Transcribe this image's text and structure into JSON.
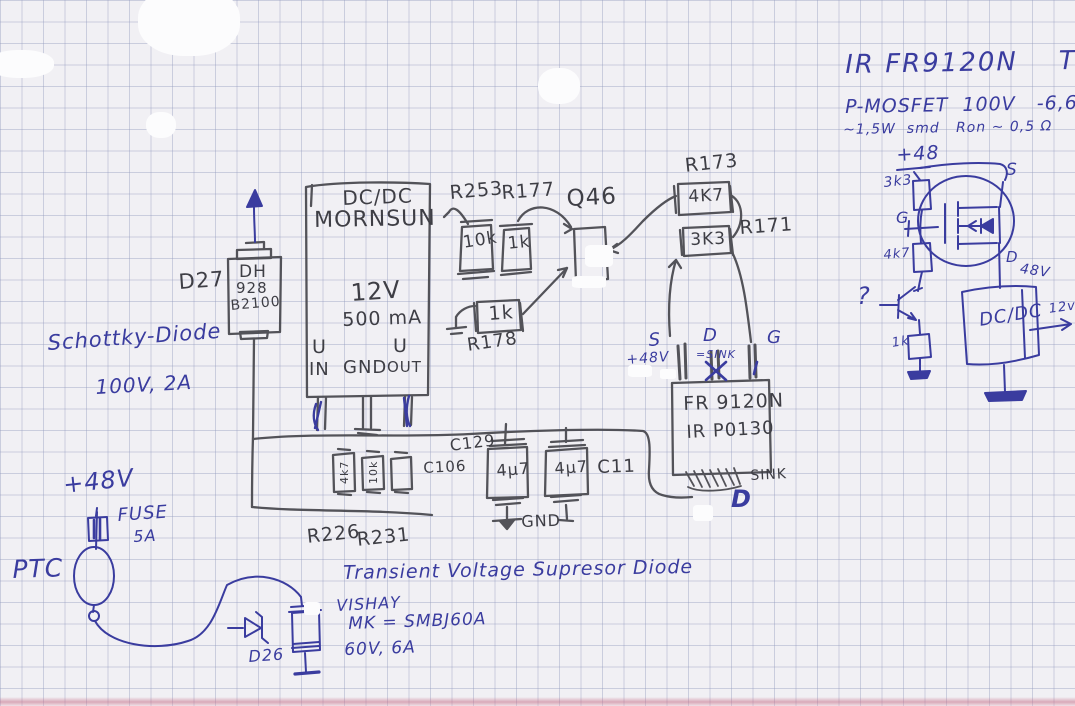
{
  "pen": {
    "mosfet_title": "IR FR9120N    TO252",
    "mosfet_specs": "P-MOSFET  100V   -6,6A",
    "mosfet_specs2": "~1,5W  smd   Ron ~ 0,5 Ω",
    "plus48_top": "+48",
    "r_3k3": "3k3",
    "gate": "G",
    "r_4k7": "4k7",
    "source": "S",
    "drain": "D",
    "drain_volt": "48V",
    "question": "?",
    "r_1k": "1k",
    "dcdc": "DC/DC",
    "out12": "12v",
    "schottky1": "Schottky-Diode",
    "schottky2": "100V, 2A",
    "rail48": "+48V",
    "fuse1": "FUSE",
    "fuse2": "5A",
    "ptc": "PTC",
    "d26": "D26",
    "tvs1": "Transient Voltage Supresor Diode",
    "tvs2": "VISHAY",
    "tvs3": "MK = SMBJ60A",
    "tvs4": "60V, 6A",
    "s_pin": "S",
    "s_note": "+48V",
    "d_pin": "D",
    "d_note": "=SINK",
    "g_pin": "G",
    "big_d": "D"
  },
  "pencil": {
    "d27_ref": "D27",
    "d27_1": "DH",
    "d27_2": "928",
    "d27_3": "B2100",
    "mornsun": {
      "t1": "DC/DC",
      "t2": "MORNSUN",
      "t3": "12V",
      "t4": "500 mA",
      "uin1": "U",
      "uin2": "IN",
      "gnd": "GND",
      "uout1": "U",
      "uout2": "OUT"
    },
    "r253_ref": "R253",
    "r253_val": "10k",
    "r177_ref": "R177",
    "r177_val": "1k",
    "q46_ref": "Q46",
    "r178_ref": "R178",
    "r178_val": "1k",
    "r173_ref": "R173",
    "r173_val": "4K7",
    "r171_ref": "R171",
    "r171_val": "3K3",
    "fr1": "FR 9120N",
    "fr2": "IR P0130",
    "sink": "SINK",
    "c129": "C129",
    "c106": "C106",
    "c11": "C11",
    "cap1": "4µ7",
    "cap2": "4µ7",
    "gnd": "GND",
    "r226": "R226",
    "r231": "R231",
    "r226_val": "4k7",
    "r231_val": "10k"
  }
}
